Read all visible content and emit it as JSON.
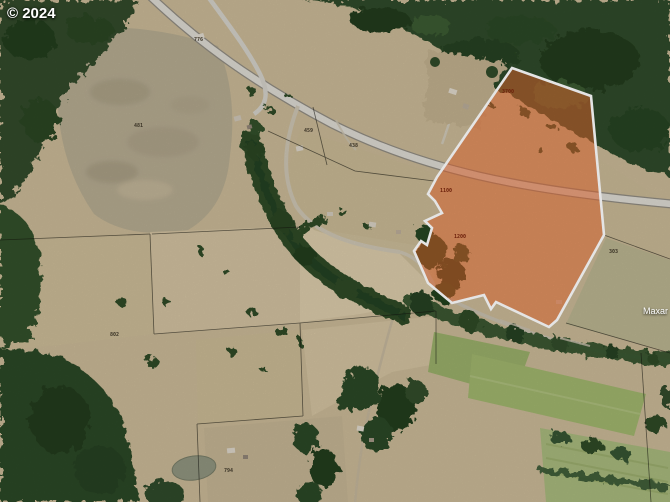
{
  "watermarks": {
    "copyright": "© 2024",
    "provider": "Maxar"
  },
  "colors": {
    "selection_fill": "#f06a2e",
    "selection_border": "#ffffff",
    "parcel_line": "#14140e"
  },
  "map_labels": [
    {
      "text": "776",
      "x": 194,
      "y": 38,
      "color": "#3a3326"
    },
    {
      "text": "481",
      "x": 134,
      "y": 124,
      "color": "#3a3326"
    },
    {
      "text": "459",
      "x": 304,
      "y": 129,
      "color": "#3a3326"
    },
    {
      "text": "438",
      "x": 349,
      "y": 144,
      "color": "#3a3326"
    },
    {
      "text": "3700",
      "x": 502,
      "y": 90,
      "color": "#6b1f0a"
    },
    {
      "text": "1100",
      "x": 440,
      "y": 189,
      "color": "#6b1f0a"
    },
    {
      "text": "1200",
      "x": 454,
      "y": 235,
      "color": "#6b1f0a"
    },
    {
      "text": "303",
      "x": 609,
      "y": 250,
      "color": "#3a3326"
    },
    {
      "text": "802",
      "x": 110,
      "y": 333,
      "color": "#3a3326"
    },
    {
      "text": "794",
      "x": 224,
      "y": 469,
      "color": "#3a3326"
    }
  ]
}
